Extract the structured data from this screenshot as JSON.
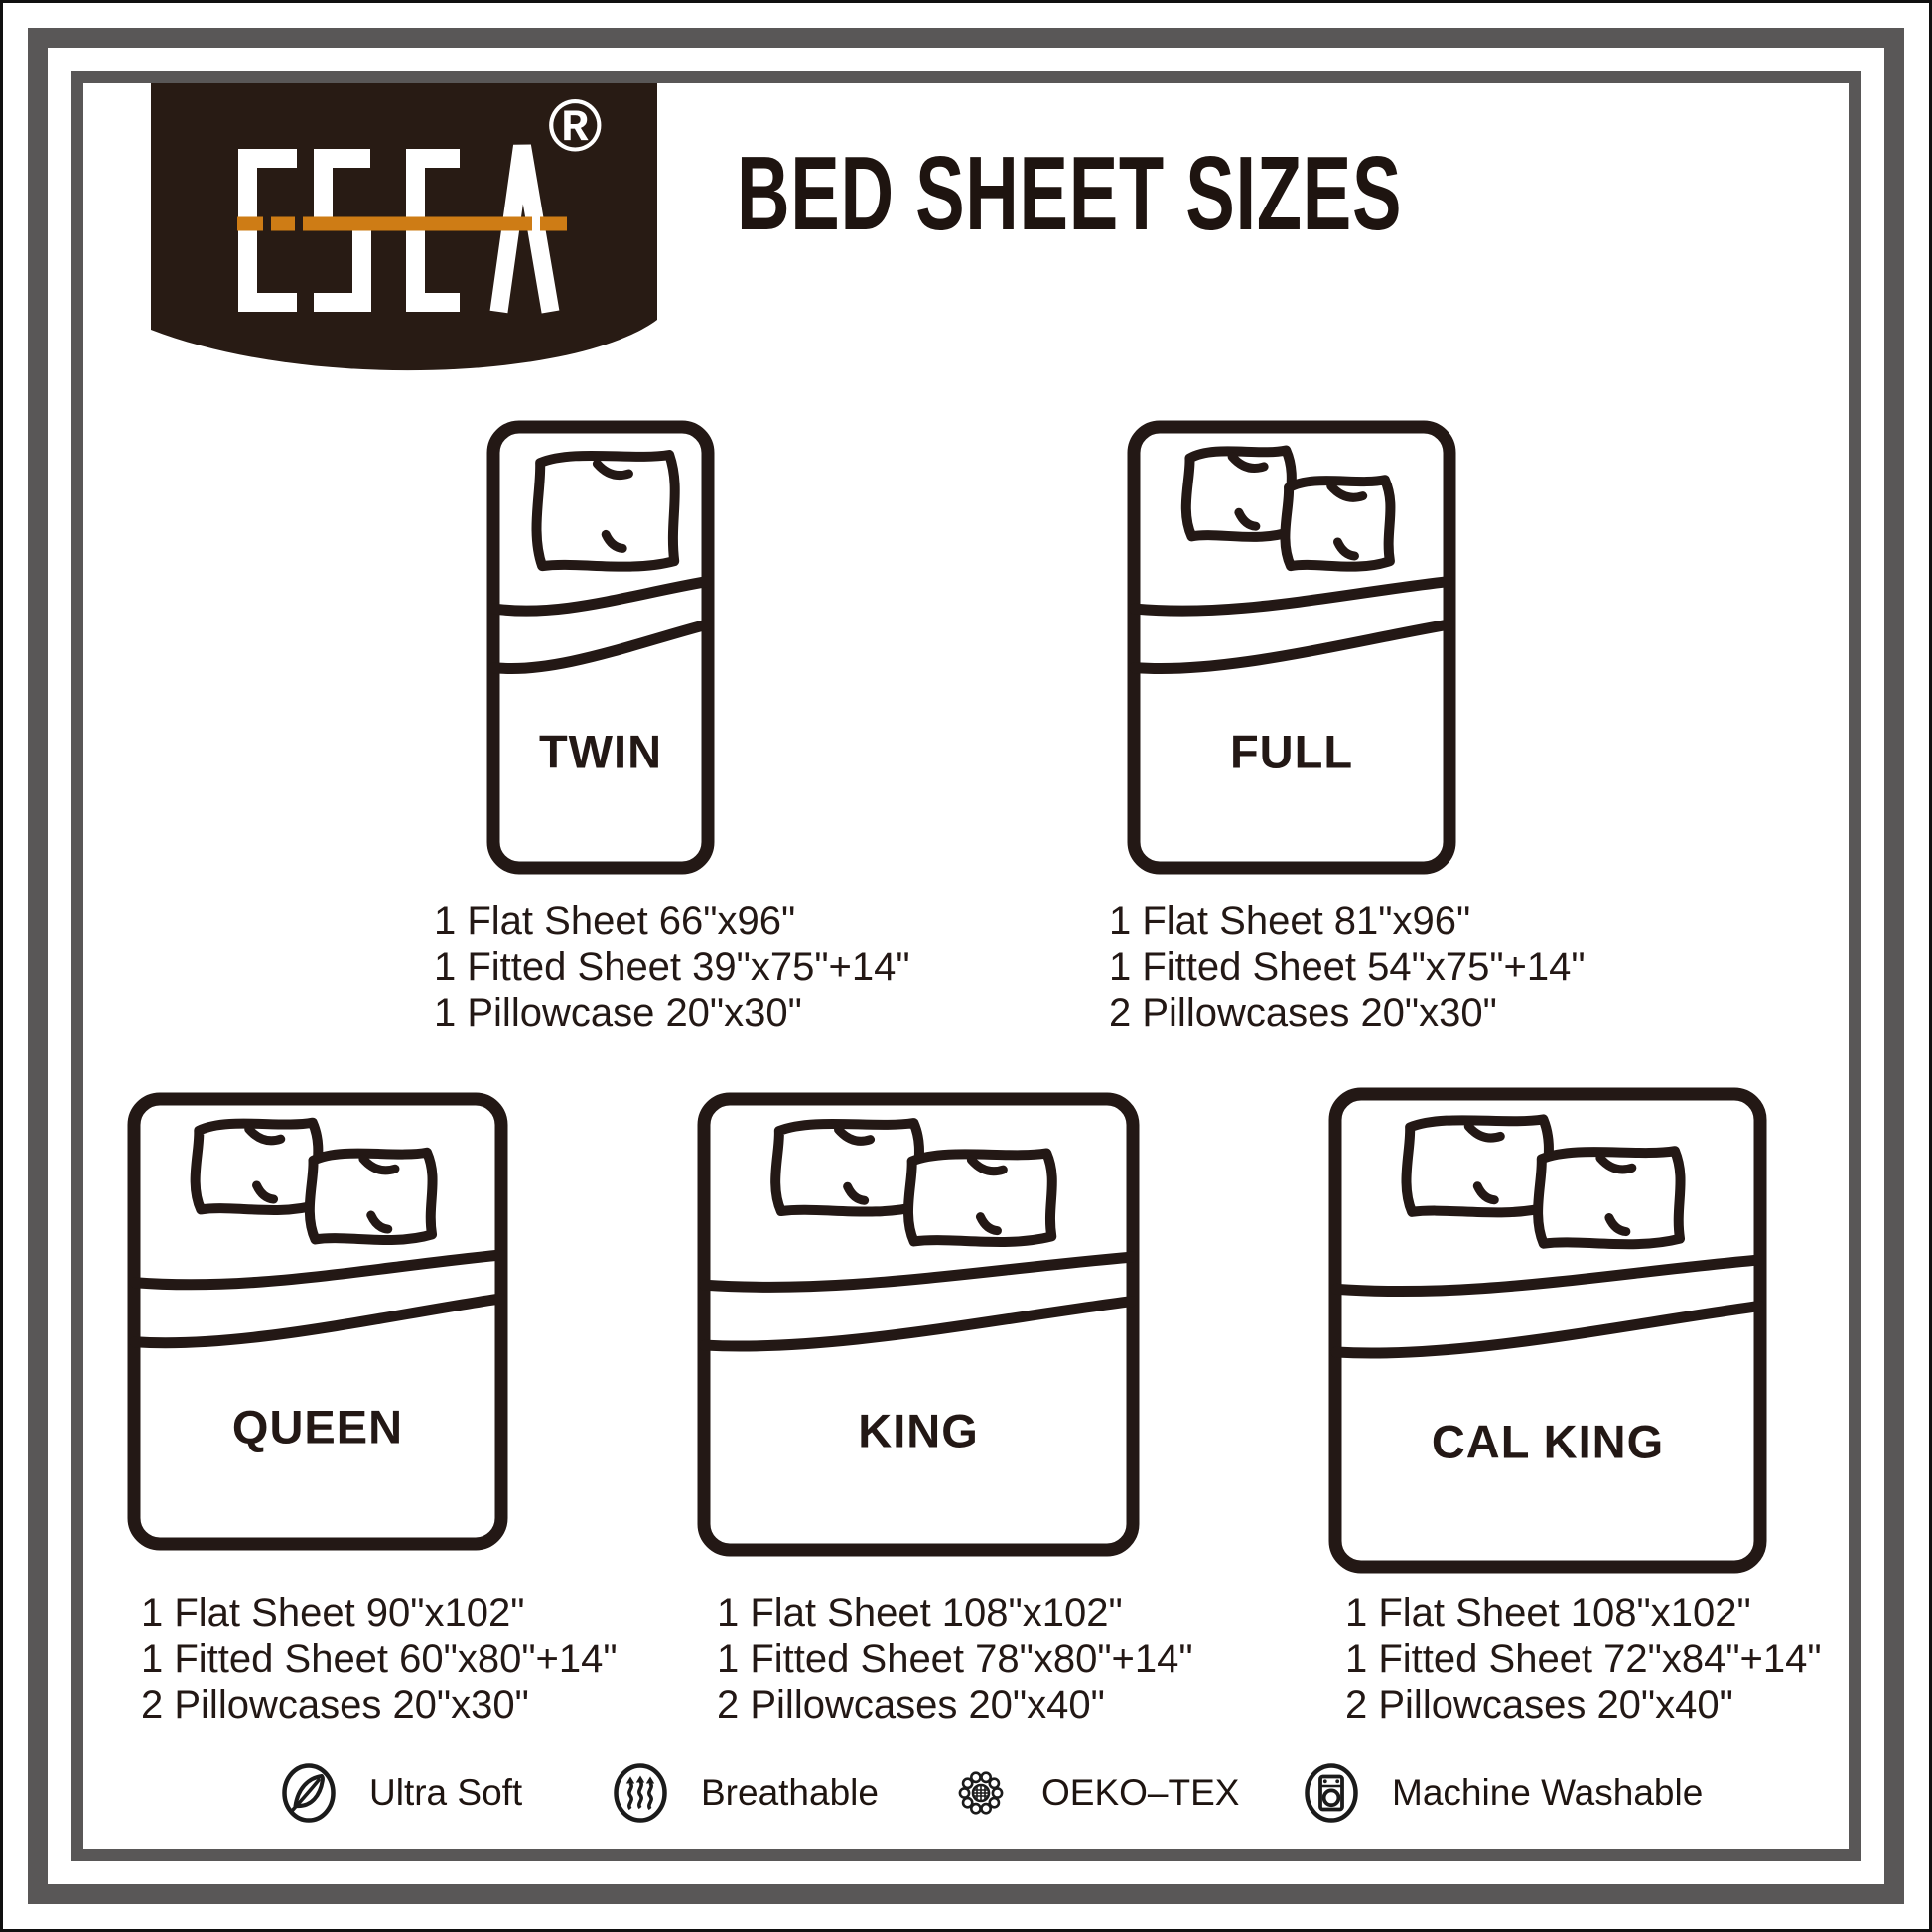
{
  "brand": {
    "name": "ESCA",
    "registered_mark": "®"
  },
  "header": {
    "title": "BED SHEET SIZES"
  },
  "beds": [
    {
      "id": "twin",
      "label": "TWIN",
      "pillows": 1,
      "specs": [
        "1 Flat Sheet 66\"x96\"",
        "1 Fitted Sheet 39\"x75\"+14\"",
        "1 Pillowcase 20\"x30\""
      ]
    },
    {
      "id": "full",
      "label": "FULL",
      "pillows": 2,
      "specs": [
        "1 Flat Sheet 81\"x96\"",
        "1 Fitted Sheet 54\"x75\"+14\"",
        "2 Pillowcases 20\"x30\""
      ]
    },
    {
      "id": "queen",
      "label": "QUEEN",
      "pillows": 2,
      "specs": [
        "1 Flat Sheet 90\"x102\"",
        "1 Fitted Sheet 60\"x80\"+14\"",
        "2 Pillowcases 20\"x30\""
      ]
    },
    {
      "id": "king",
      "label": "KING",
      "pillows": 2,
      "specs": [
        "1 Flat Sheet 108\"x102\"",
        "1 Fitted Sheet 78\"x80\"+14\"",
        "2 Pillowcases 20\"x40\""
      ]
    },
    {
      "id": "cal-king",
      "label": "CAL KING",
      "pillows": 2,
      "specs": [
        "1 Flat Sheet 108\"x102\"",
        "1 Fitted Sheet 72\"x84\"+14\"",
        "2 Pillowcases 20\"x40\""
      ]
    }
  ],
  "features": [
    {
      "icon": "feather-icon",
      "label": "Ultra Soft"
    },
    {
      "icon": "breathable-icon",
      "label": "Breathable"
    },
    {
      "icon": "oeko-tex-icon",
      "label": "OEKO–TEX"
    },
    {
      "icon": "washing-machine-icon",
      "label": "Machine Washable"
    }
  ],
  "colors": {
    "ink": "#231815",
    "frame_gray": "#595757",
    "accent_orange": "#ce7c15",
    "banner_brown": "#281b14"
  }
}
